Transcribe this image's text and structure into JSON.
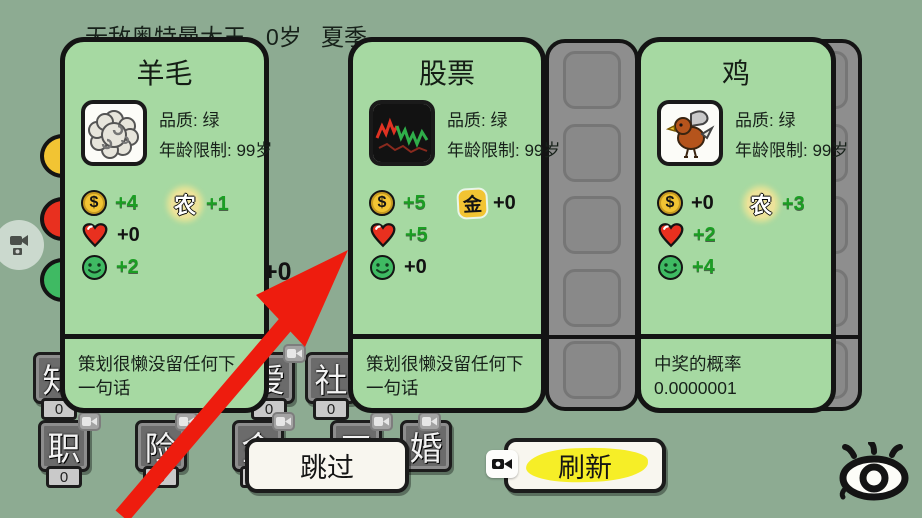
{
  "header": {
    "title": "无敌奥特曼大王",
    "age": "0岁",
    "season": "夏季"
  },
  "cards": [
    {
      "title": "羊毛",
      "art": "wool",
      "quality": "品质: 绿",
      "age_limit": "年龄限制: 99岁",
      "stats": [
        {
          "icon": "coin-icon",
          "value": "+4"
        },
        {
          "icon": "heart-icon",
          "value": "+0"
        },
        {
          "icon": "smiley-icon",
          "value": "+2"
        }
      ],
      "tag": {
        "icon": "farm-icon",
        "label": "农",
        "value": "+1"
      },
      "description": "策划很懒没留任何下一句话"
    },
    {
      "title": "股票",
      "art": "stock-chart",
      "quality": "品质: 绿",
      "age_limit": "年龄限制: 99岁",
      "stats": [
        {
          "icon": "coin-icon",
          "value": "+5"
        },
        {
          "icon": "heart-icon",
          "value": "+5"
        },
        {
          "icon": "smiley-icon",
          "value": "+0"
        }
      ],
      "tag": {
        "icon": "gold-icon",
        "label": "金",
        "value": "+0"
      },
      "description": "策划很懒没留任何下一句话"
    },
    {
      "title": "鸡",
      "art": "chicken",
      "quality": "品质: 绿",
      "age_limit": "年龄限制: 99岁",
      "stats": [
        {
          "icon": "coin-icon",
          "value": "+0"
        },
        {
          "icon": "heart-icon",
          "value": "+2"
        },
        {
          "icon": "smiley-icon",
          "value": "+4"
        }
      ],
      "tag": {
        "icon": "farm-icon",
        "label": "农",
        "value": "+3"
      },
      "description": "中奖的概率0.0000001"
    }
  ],
  "actions": {
    "skip": "跳过",
    "refresh": "刷新"
  },
  "background": {
    "gap_counter": "0",
    "gap_value": "+0",
    "stat_buttons": [
      {
        "label": "知",
        "count": "0"
      },
      {
        "label": "爱",
        "count": "0"
      },
      {
        "label": "社",
        "count": "0"
      },
      {
        "label": "职",
        "count": "0"
      },
      {
        "label": "险",
        "count": "0"
      },
      {
        "label": "金",
        "count": "0"
      },
      {
        "label": "工",
        "count": "0"
      },
      {
        "label": "婚",
        "count": "0"
      }
    ]
  },
  "colors": {
    "background": "#8dab92",
    "card_green": "#a6d9a2",
    "highlight_yellow": "#f6ee27",
    "arrow_red": "#ee1c0e",
    "coin_yellow": "#f2c433",
    "heart_red": "#e8301f",
    "smiley_green": "#3fba63",
    "positive_value_green": "#1b9e23"
  }
}
